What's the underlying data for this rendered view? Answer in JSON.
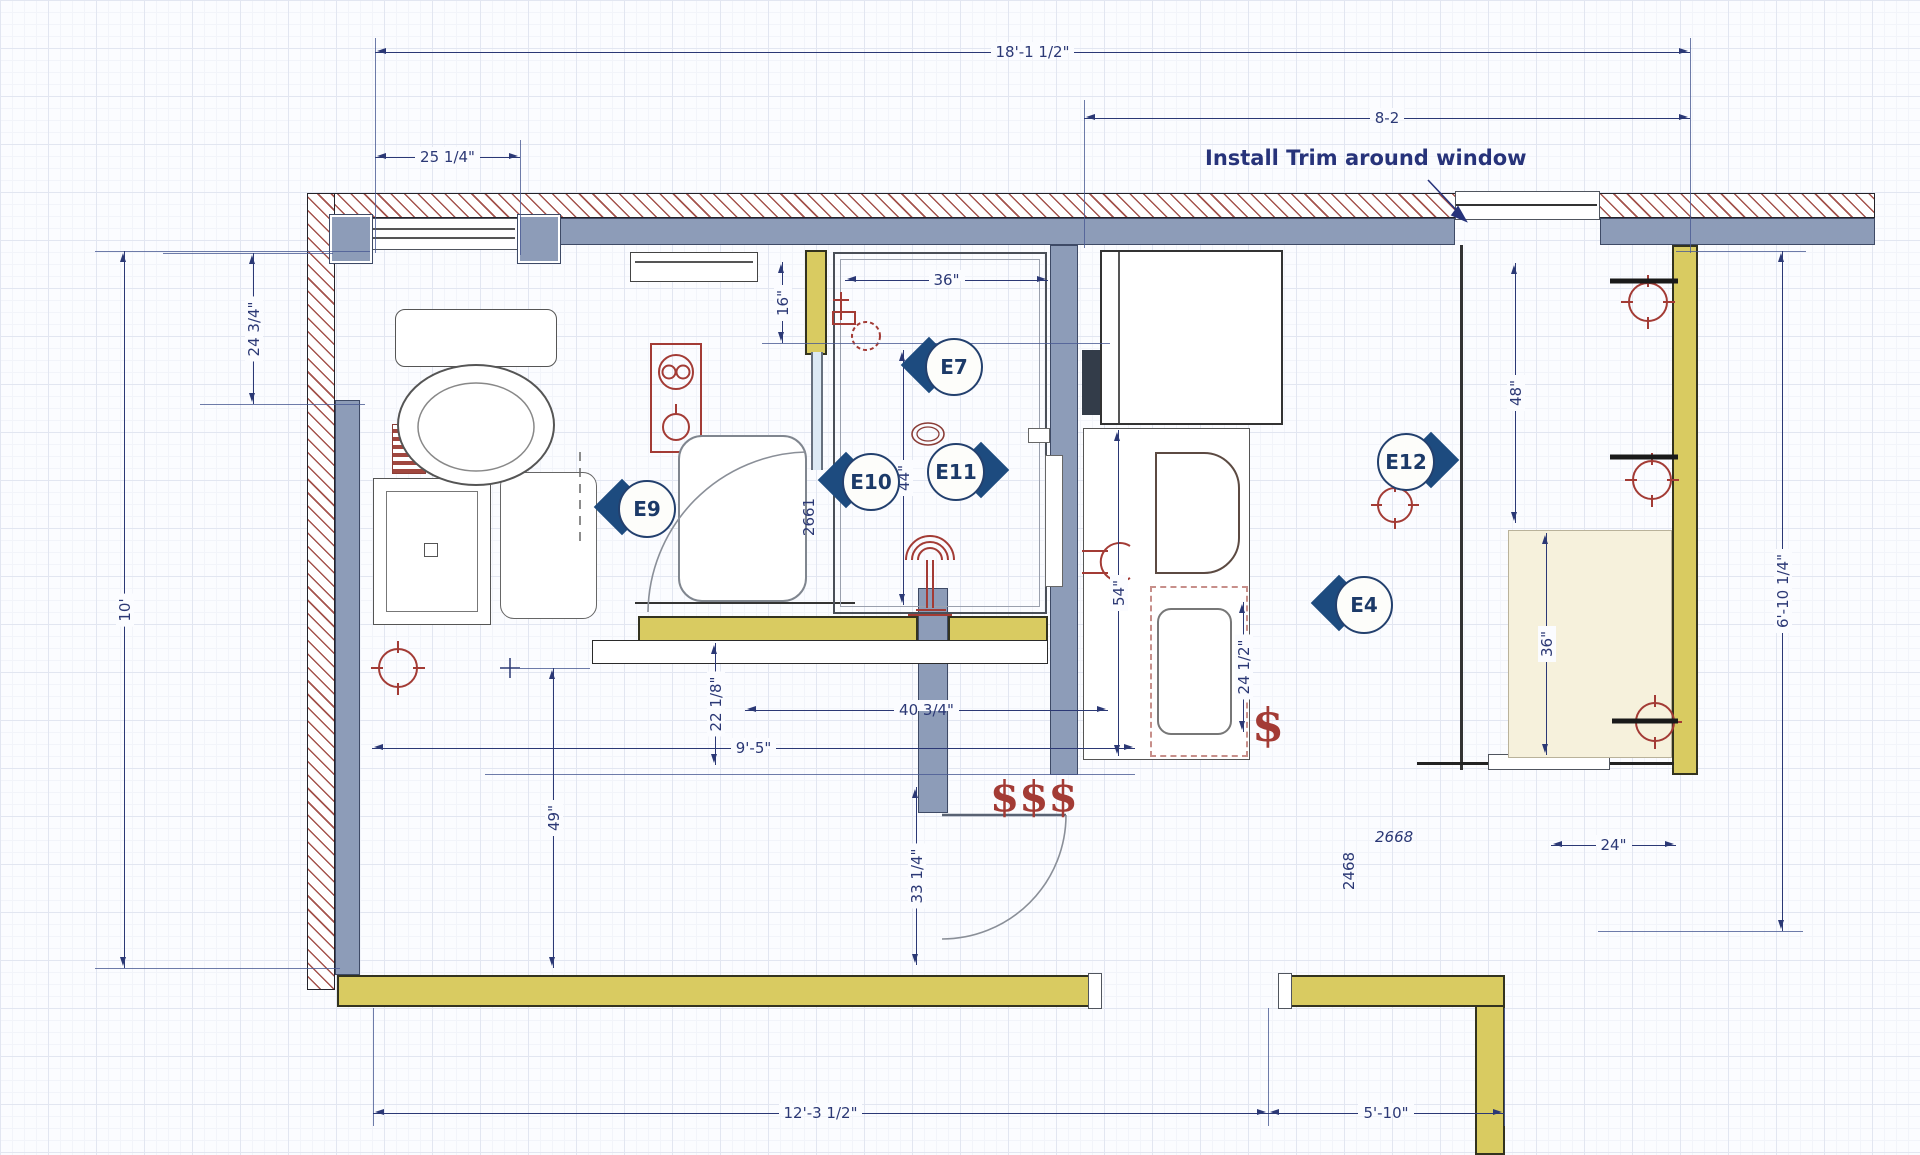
{
  "annotation": {
    "install_trim": "Install Trim around window"
  },
  "dims": {
    "overall_top": "18'-1 1/2\"",
    "top_right": "8-2",
    "toilet_width": "25 1/4\"",
    "left_upper": "24 3/4\"",
    "left_height": "10'",
    "niche": "16\"",
    "shower_width": "36\"",
    "shower_len": "44\"",
    "closet_upper": "48\"",
    "closet_height": "6'-10 1/4\"",
    "vanity_len": "54\"",
    "vanity_depth": "24 1/2\"",
    "closet_lower": "36\"",
    "pan_width": "40 3/4\"",
    "step": "22 1/8\"",
    "room_len": "9'-5\"",
    "wall_seg": "49\"",
    "entry": "33 1/4\"",
    "bench_depth": "24\"",
    "bottom_left": "12'-3 1/2\"",
    "bottom_right": "5'-10\"",
    "door_shower": "2661",
    "door_a": "2668",
    "door_b": "2468",
    "cost_single": "$",
    "cost_triple": "$$$"
  },
  "markers": [
    {
      "label": "E7",
      "dir": "left"
    },
    {
      "label": "E9",
      "dir": "left"
    },
    {
      "label": "E10",
      "dir": "left"
    },
    {
      "label": "E11",
      "dir": "right"
    },
    {
      "label": "E12",
      "dir": "right"
    },
    {
      "label": "E4",
      "dir": "left"
    }
  ],
  "colors": {
    "wall_gray": "#8d9cb8",
    "wall_yellow": "#d9cb61",
    "hatch_red": "#a4534c",
    "dim_navy": "#2b3875",
    "marker_blue": "#1d4b7f",
    "fixture_red": "#a33b35",
    "bench_beige": "#f6f1dc"
  }
}
